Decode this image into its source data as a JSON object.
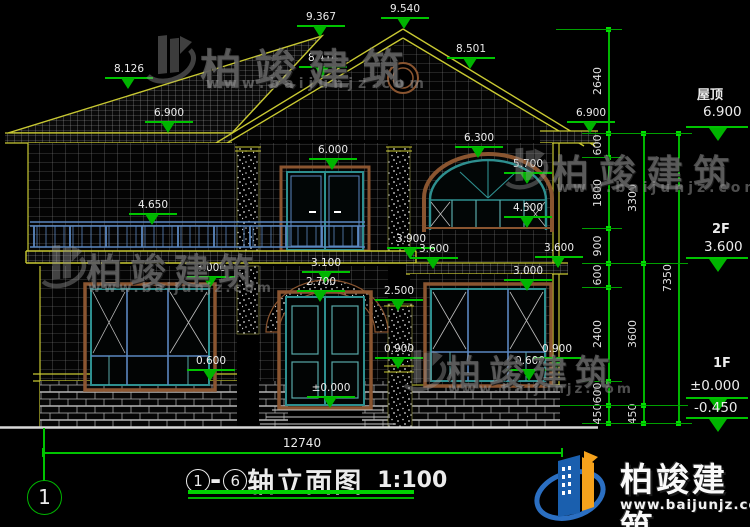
{
  "title": {
    "axis_from": "1",
    "axis_to": "6",
    "dash": "-",
    "name": "轴立面图",
    "scale": "1:100"
  },
  "axis_bubble": "1",
  "dims": {
    "total_width": "12740"
  },
  "levels_right": [
    {
      "label": "屋顶",
      "value": "6.900"
    },
    {
      "label": "2F",
      "value": "3.600"
    },
    {
      "label": "1F",
      "value": "±0.000"
    },
    {
      "label": "",
      "value": "-0.450"
    }
  ],
  "level_markers": [
    {
      "v": "8.126",
      "x": 128,
      "y": 77
    },
    {
      "v": "9.367",
      "x": 320,
      "y": 25
    },
    {
      "v": "9.540",
      "x": 404,
      "y": 17
    },
    {
      "v": "8.414",
      "x": 322,
      "y": 66
    },
    {
      "v": "8.501",
      "x": 470,
      "y": 57
    },
    {
      "v": "6.900",
      "x": 168,
      "y": 121
    },
    {
      "v": "6.900",
      "x": 590,
      "y": 121
    },
    {
      "v": "6.000",
      "x": 332,
      "y": 158
    },
    {
      "v": "6.300",
      "x": 478,
      "y": 146
    },
    {
      "v": "5.700",
      "x": 527,
      "y": 172
    },
    {
      "v": "4.650",
      "x": 152,
      "y": 213
    },
    {
      "v": "4.500",
      "x": 527,
      "y": 216
    },
    {
      "v": "3.900",
      "x": 410,
      "y": 247
    },
    {
      "v": "3.600",
      "x": 433,
      "y": 257
    },
    {
      "v": "3.600",
      "x": 558,
      "y": 256
    },
    {
      "v": "3.000",
      "x": 210,
      "y": 276
    },
    {
      "v": "3.100",
      "x": 325,
      "y": 271
    },
    {
      "v": "2.700",
      "x": 320,
      "y": 290
    },
    {
      "v": "2.500",
      "x": 398,
      "y": 299
    },
    {
      "v": "3.000",
      "x": 527,
      "y": 279
    },
    {
      "v": "0.900",
      "x": 398,
      "y": 357
    },
    {
      "v": "0.900",
      "x": 556,
      "y": 357
    },
    {
      "v": "0.600",
      "x": 210,
      "y": 369
    },
    {
      "v": "0.600",
      "x": 529,
      "y": 369
    },
    {
      "v": "±0.000",
      "x": 330,
      "y": 396
    }
  ],
  "dim_chains": [
    {
      "x": 608,
      "ticks": [
        29,
        133,
        157,
        228,
        263,
        287,
        381,
        405,
        423
      ],
      "labels": [
        "2640",
        "600",
        "1800",
        "900",
        "600",
        "2400",
        "600",
        "450"
      ]
    },
    {
      "x": 643,
      "ticks": [
        133,
        263,
        405,
        423
      ],
      "labels": [
        "3300",
        "3600",
        "450"
      ]
    },
    {
      "x": 678,
      "ticks": [
        133,
        423
      ],
      "labels": [
        "7350"
      ]
    }
  ],
  "watermark": {
    "company": "柏竣建筑",
    "url": "www.baijunjz.com"
  },
  "brand": {
    "company": "柏竣建筑",
    "url": "www.baijunjz.com"
  },
  "colors": {
    "dimension_green": "#00c400",
    "cad_yellow": "#c8c832",
    "frame_teal": "#2e8f8f",
    "mullion_blue": "#5b87c0",
    "surround_brown": "#8a5530",
    "logo_blue": "#1a5fae",
    "logo_orange": "#f6a21c"
  }
}
